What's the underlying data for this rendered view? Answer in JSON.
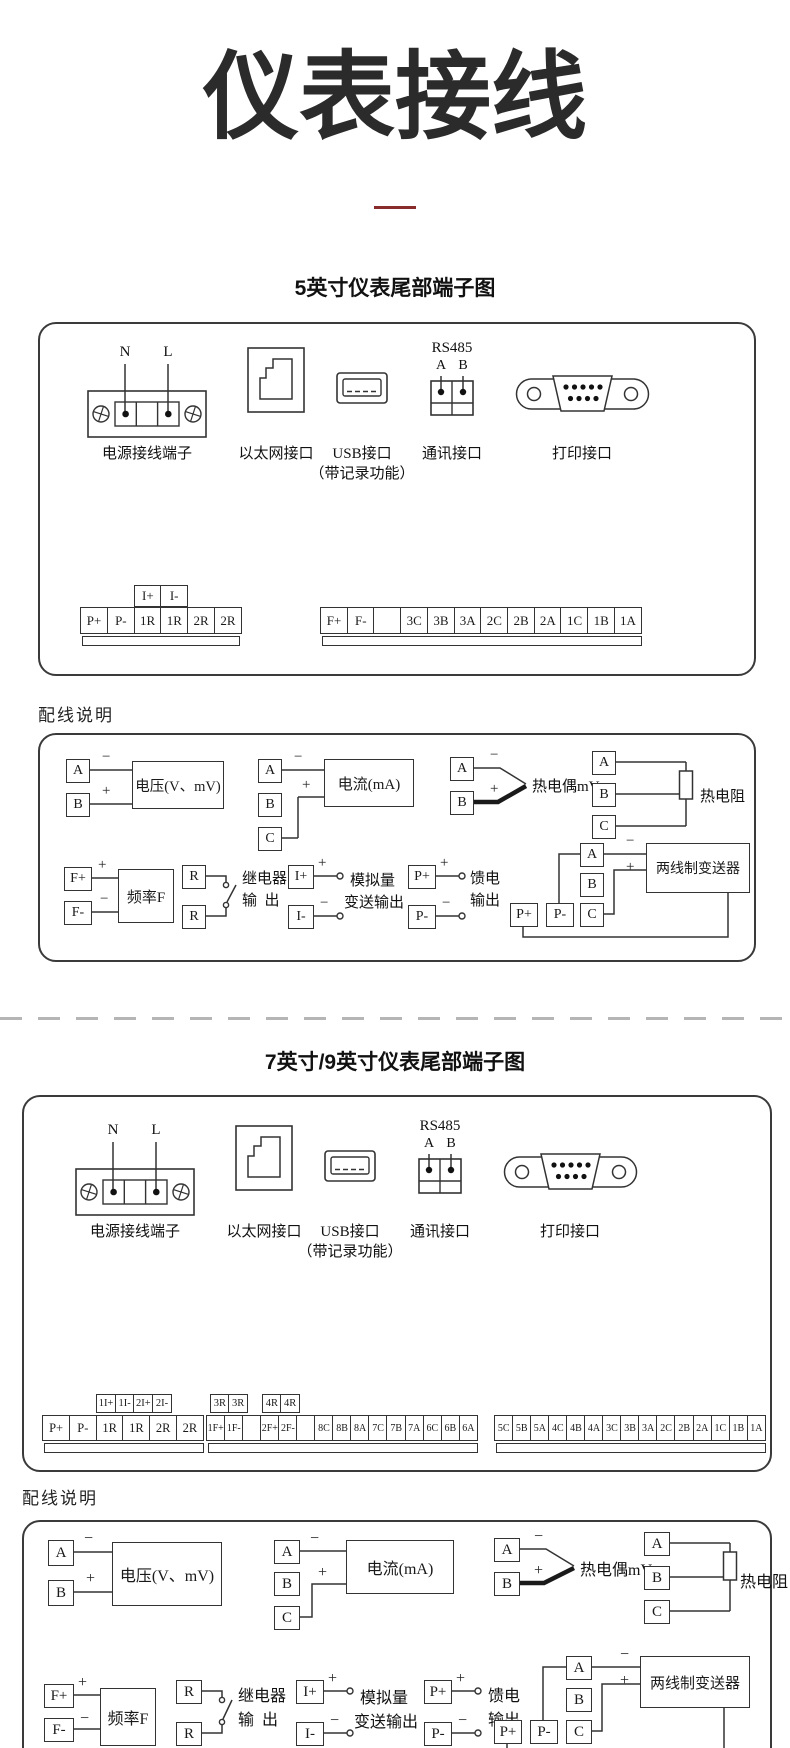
{
  "page": {
    "title": "仪表接线"
  },
  "sections": {
    "s5": {
      "title": "5英寸仪表尾部端子图",
      "wiring_note": "配线说明"
    },
    "s79": {
      "title": "7英寸/9英寸仪表尾部端子图",
      "wiring_note": "配线说明"
    }
  },
  "connectors": {
    "n": "N",
    "l": "L",
    "power_label": "电源接线端子",
    "ethernet_label": "以太网接口",
    "usb_label": "USB接口",
    "usb_sublabel": "（带记录功能）",
    "rs485_title": "RS485",
    "rs485_a": "A",
    "rs485_b": "B",
    "comm_label": "通讯接口",
    "print_label": "打印接口"
  },
  "terminals_5inch": {
    "current_loop_row": [
      "I+",
      "I-"
    ],
    "left_row": [
      "P+",
      "P-",
      "1R",
      "1R",
      "2R",
      "2R"
    ],
    "right_row": [
      "F+",
      "F-",
      "",
      "3C",
      "3B",
      "3A",
      "2C",
      "2B",
      "2A",
      "1C",
      "1B",
      "1A"
    ]
  },
  "terminals_79inch": {
    "current_loop_row": [
      "1I+",
      "1I-",
      "2I+",
      "2I-"
    ],
    "relay3_row": [
      "3R",
      "3R"
    ],
    "relay4_row": [
      "4R",
      "4R"
    ],
    "strip1": [
      "P+",
      "P-",
      "1R",
      "1R",
      "2R",
      "2R"
    ],
    "strip2": [
      "1F+",
      "1F-",
      "",
      "2F+",
      "2F-",
      "",
      "8C",
      "8B",
      "8A",
      "7C",
      "7B",
      "7A",
      "6C",
      "6B",
      "6A"
    ],
    "strip3": [
      "5C",
      "5B",
      "5A",
      "4C",
      "4B",
      "4A",
      "3C",
      "3B",
      "3A",
      "2C",
      "2B",
      "2A",
      "1C",
      "1B",
      "1A"
    ]
  },
  "wiring": {
    "a": "A",
    "b": "B",
    "c": "C",
    "plus": "+",
    "minus": "−",
    "voltage_label": "电压(V、mV)",
    "current_label": "电流(mA)",
    "thermocouple_label": "热电偶mV",
    "rtd_label": "热电阻",
    "fp": "F+",
    "fm": "F-",
    "frequency_label": "频率F",
    "r": "R",
    "relay_label_1": "继电器",
    "relay_label_2": "输  出",
    "ip": "I+",
    "im": "I-",
    "analog_label_1": "模拟量",
    "analog_label_2": "变送输出",
    "pp": "P+",
    "pm": "P-",
    "feed_label_1": "馈电",
    "feed_label_2": "输出",
    "transmitter_label": "两线制变送器"
  }
}
